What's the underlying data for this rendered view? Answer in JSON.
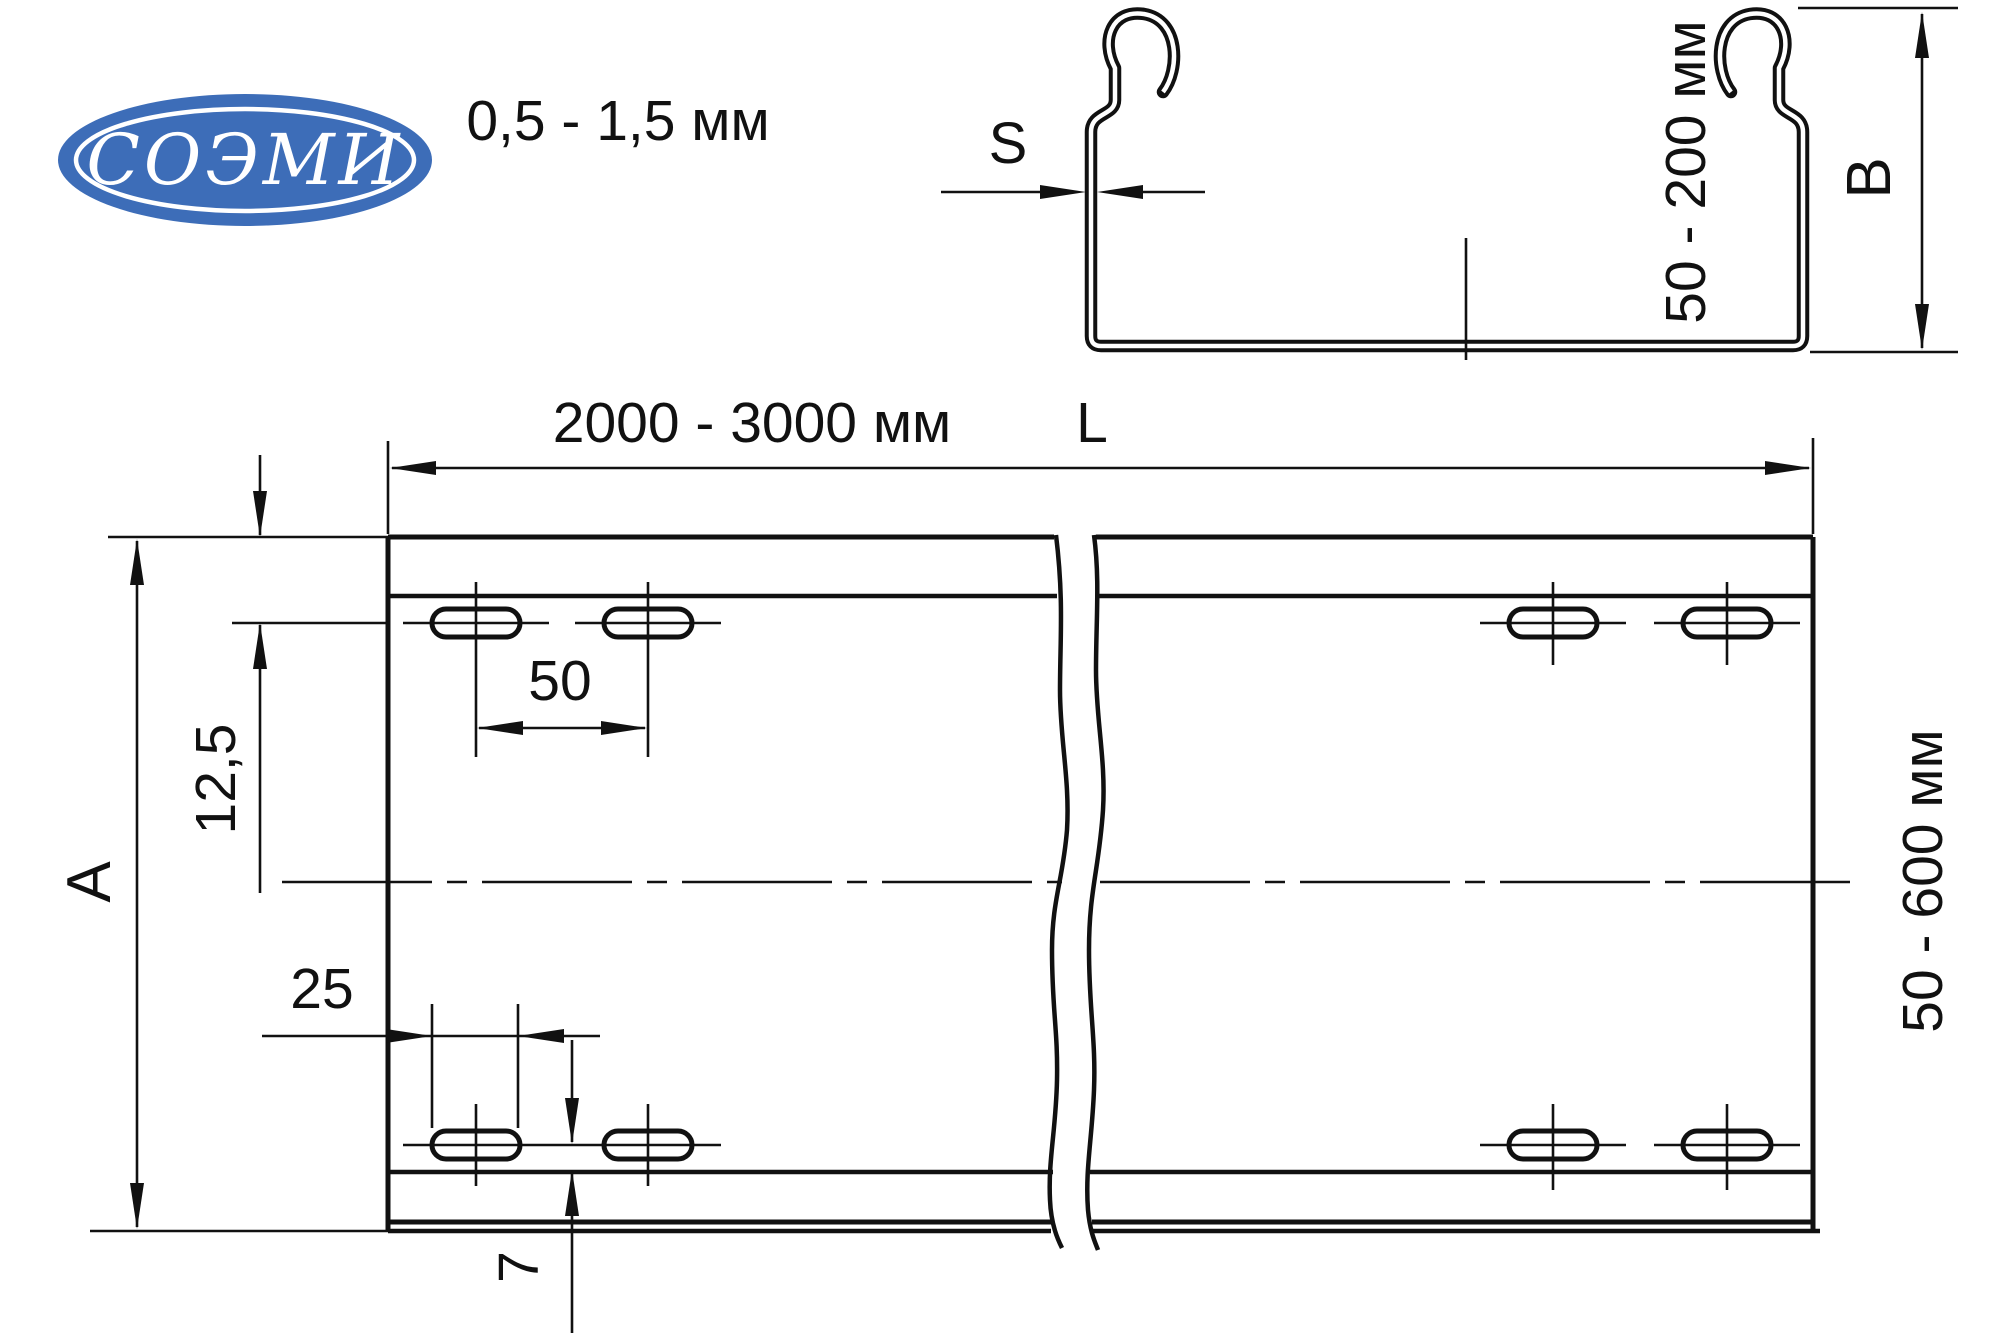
{
  "logo": {
    "text": "СОЭМИ",
    "color": "#3d6db8"
  },
  "section_view": {
    "thickness_label": "0,5 - 1,5 мм",
    "thickness_symbol": "S",
    "height_label": "50 - 200 мм",
    "height_symbol": "B"
  },
  "plan_view": {
    "length_label": "2000 - 3000 мм",
    "length_symbol": "L",
    "width_label": "50 - 600 мм",
    "width_symbol": "A",
    "dim_edge_to_slot_row": "12,5",
    "dim_slot_spacing": "50",
    "dim_slot_length": "25",
    "dim_slot_to_edge": "7"
  }
}
